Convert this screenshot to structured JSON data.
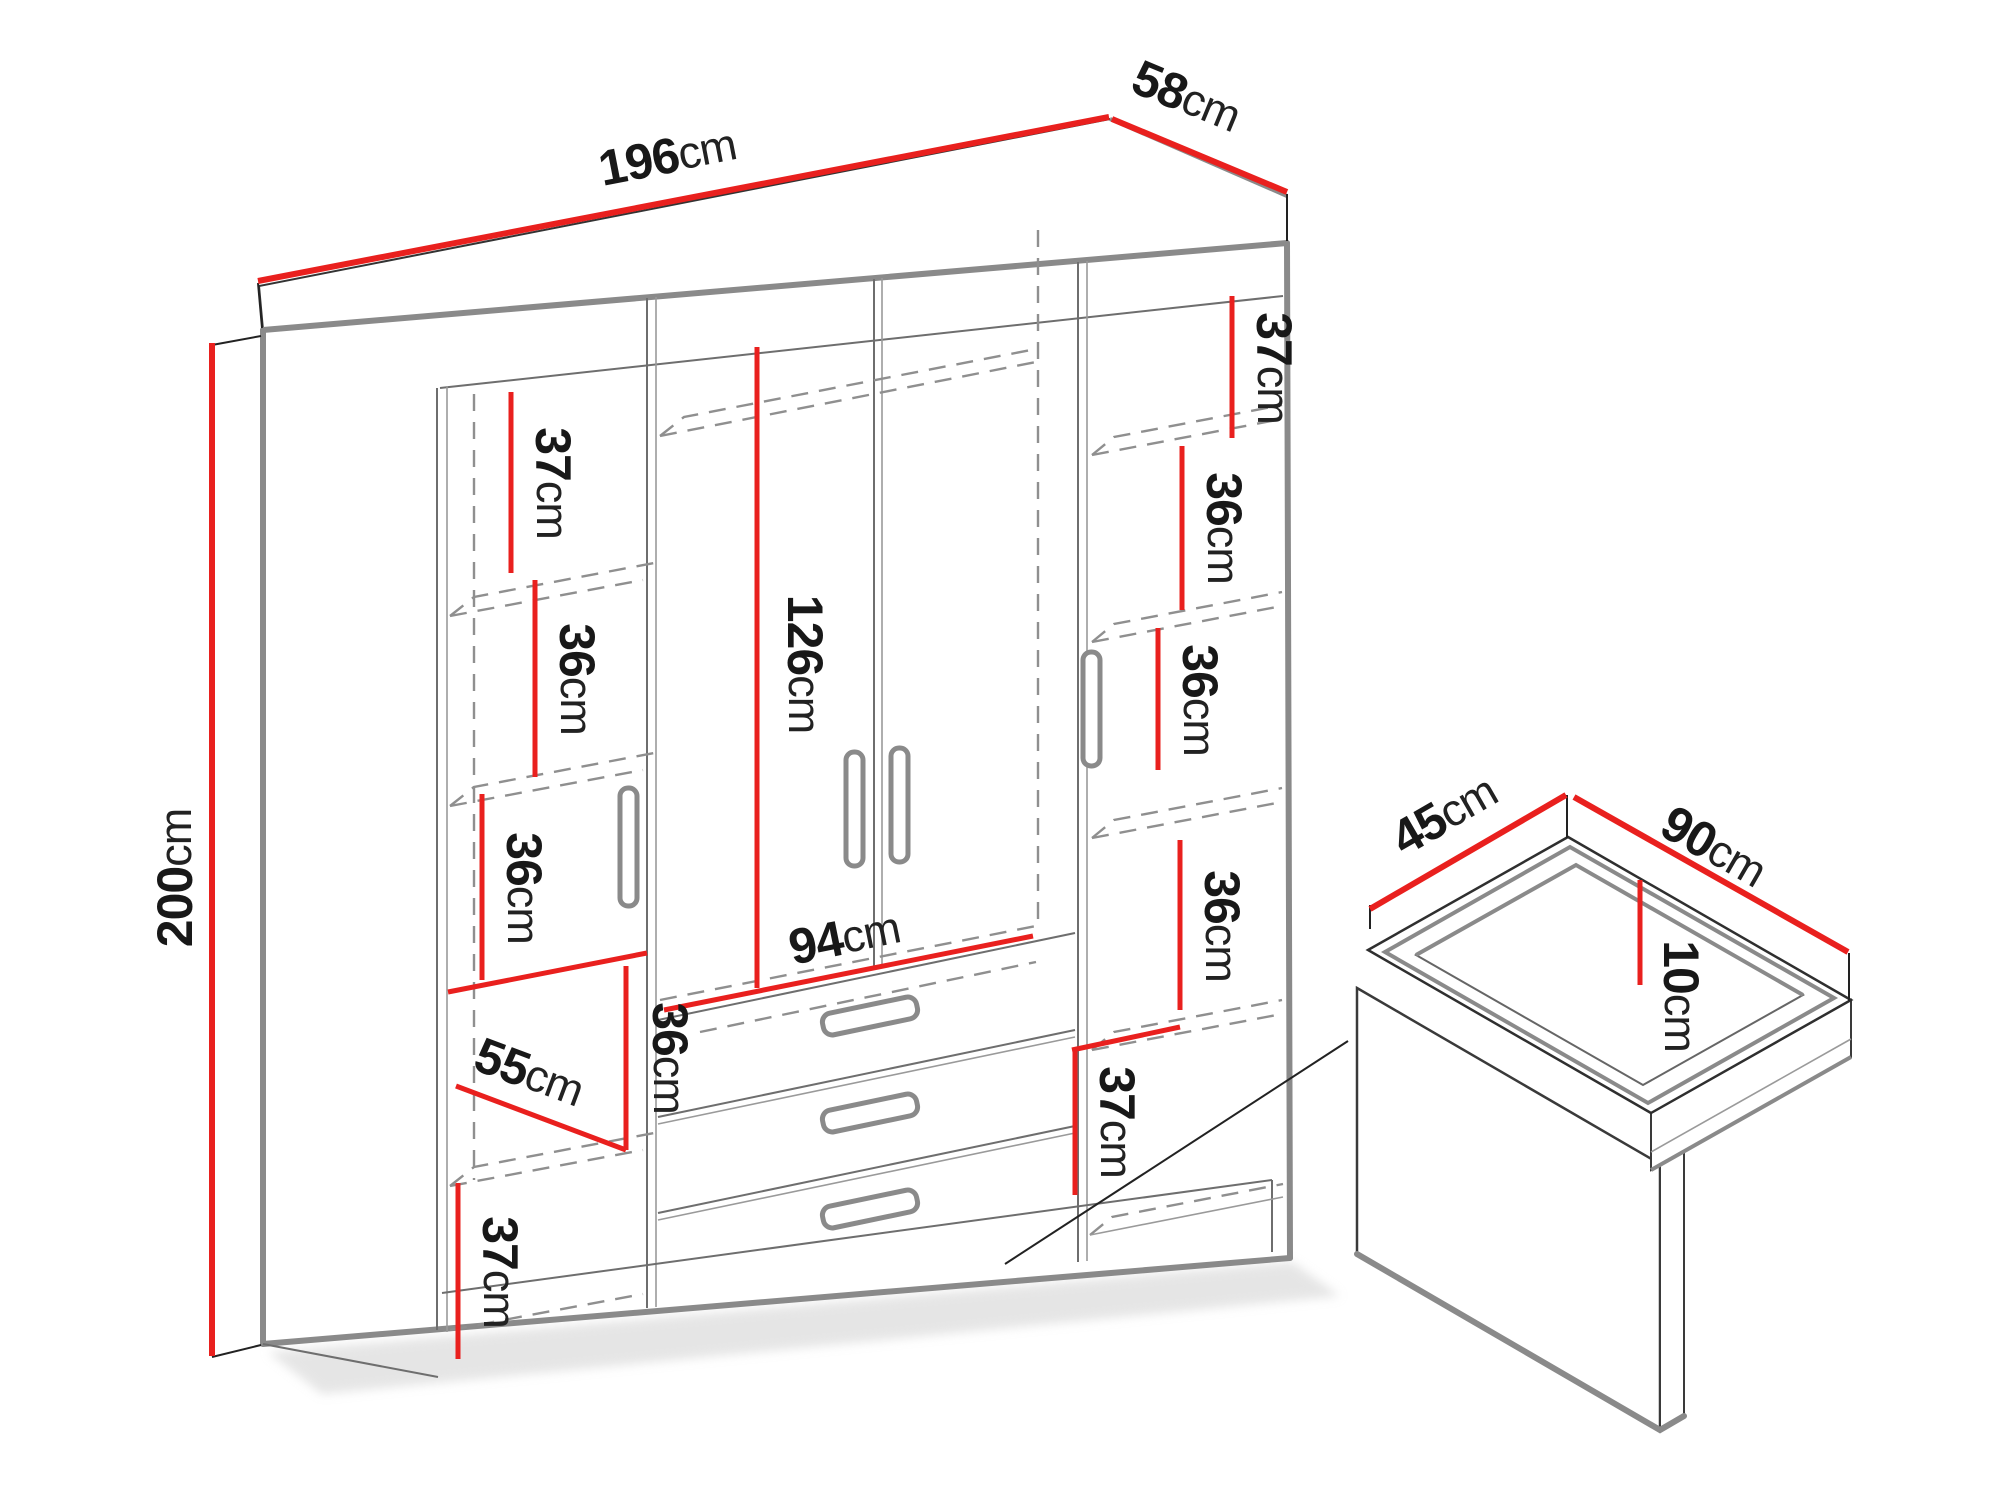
{
  "diagram_title": "wardrobe-dimensions-diagram",
  "colors": {
    "dimension_red": "#e9201e",
    "edge_gray": "#8a8a8a",
    "text_black": "#181818"
  },
  "labels": {
    "width": {
      "num": "196",
      "unit": "cm"
    },
    "depth": {
      "num": "58",
      "unit": "cm"
    },
    "height": {
      "num": "200",
      "unit": "cm"
    },
    "left_shelf_top": {
      "num": "37",
      "unit": "cm"
    },
    "left_shelf_2": {
      "num": "36",
      "unit": "cm"
    },
    "left_shelf_3": {
      "num": "36",
      "unit": "cm"
    },
    "left_above_drawers": {
      "num": "36",
      "unit": "cm"
    },
    "left_width": {
      "num": "55",
      "unit": "cm"
    },
    "left_shelf_bottom": {
      "num": "37",
      "unit": "cm"
    },
    "hanging_height": {
      "num": "126",
      "unit": "cm"
    },
    "drawers_width": {
      "num": "94",
      "unit": "cm"
    },
    "right_shelf_top": {
      "num": "37",
      "unit": "cm"
    },
    "right_shelf_2": {
      "num": "36",
      "unit": "cm"
    },
    "right_shelf_3": {
      "num": "36",
      "unit": "cm"
    },
    "right_shelf_4": {
      "num": "36",
      "unit": "cm"
    },
    "right_shelf_bottom": {
      "num": "37",
      "unit": "cm"
    },
    "drawer_depth": {
      "num": "45",
      "unit": "cm"
    },
    "drawer_width": {
      "num": "90",
      "unit": "cm"
    },
    "drawer_height": {
      "num": "10",
      "unit": "cm"
    }
  }
}
